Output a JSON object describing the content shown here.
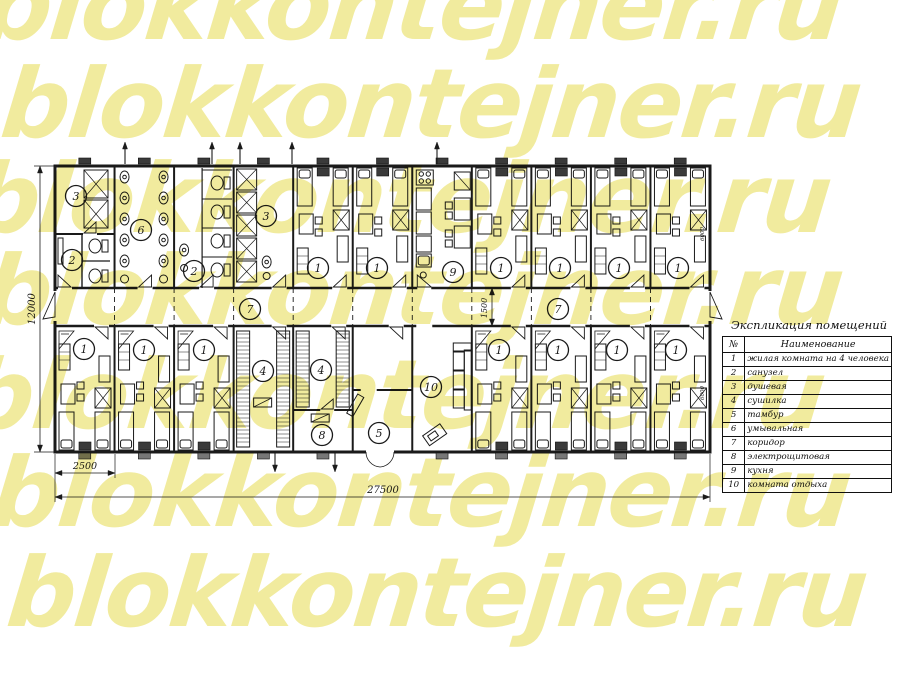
{
  "watermark": {
    "text": "blokkontejner.ru",
    "color": "#f1eb9e",
    "row_count": 7
  },
  "legend": {
    "title": "Экспликация помещений",
    "columns": {
      "no": "№",
      "name": "Наименование"
    },
    "rows": [
      {
        "no": "1",
        "name": "жилая комната на 4 человека"
      },
      {
        "no": "2",
        "name": "санузел"
      },
      {
        "no": "3",
        "name": "душевая"
      },
      {
        "no": "4",
        "name": "сушилка"
      },
      {
        "no": "5",
        "name": "тамбур"
      },
      {
        "no": "6",
        "name": "умывальная"
      },
      {
        "no": "7",
        "name": "коридор"
      },
      {
        "no": "8",
        "name": "электрощитовая"
      },
      {
        "no": "9",
        "name": "кухня"
      },
      {
        "no": "10",
        "name": "комната отдыха"
      }
    ]
  },
  "plan": {
    "dimensions": {
      "total_length": "27500",
      "module_width": "2500",
      "total_width": "12000",
      "corridor_width": "1500",
      "container_length": "6000"
    },
    "room_labels": [
      {
        "n": "3",
        "x": 76,
        "y": 196
      },
      {
        "n": "2",
        "x": 72,
        "y": 260
      },
      {
        "n": "6",
        "x": 141,
        "y": 230
      },
      {
        "n": "2",
        "x": 194,
        "y": 271
      },
      {
        "n": "3",
        "x": 266,
        "y": 216
      },
      {
        "n": "1",
        "x": 318,
        "y": 268
      },
      {
        "n": "1",
        "x": 377,
        "y": 268
      },
      {
        "n": "9",
        "x": 453,
        "y": 272
      },
      {
        "n": "1",
        "x": 501,
        "y": 268
      },
      {
        "n": "1",
        "x": 560,
        "y": 268
      },
      {
        "n": "1",
        "x": 619,
        "y": 268
      },
      {
        "n": "1",
        "x": 678,
        "y": 268
      },
      {
        "n": "7",
        "x": 250,
        "y": 309
      },
      {
        "n": "7",
        "x": 558,
        "y": 309
      },
      {
        "n": "1",
        "x": 84,
        "y": 349
      },
      {
        "n": "1",
        "x": 144,
        "y": 350
      },
      {
        "n": "1",
        "x": 204,
        "y": 350
      },
      {
        "n": "4",
        "x": 263,
        "y": 371
      },
      {
        "n": "4",
        "x": 321,
        "y": 370
      },
      {
        "n": "8",
        "x": 322,
        "y": 435
      },
      {
        "n": "5",
        "x": 379,
        "y": 433
      },
      {
        "n": "10",
        "x": 431,
        "y": 387
      },
      {
        "n": "1",
        "x": 499,
        "y": 350
      },
      {
        "n": "1",
        "x": 558,
        "y": 350
      },
      {
        "n": "1",
        "x": 617,
        "y": 350
      },
      {
        "n": "1",
        "x": 676,
        "y": 350
      }
    ]
  }
}
